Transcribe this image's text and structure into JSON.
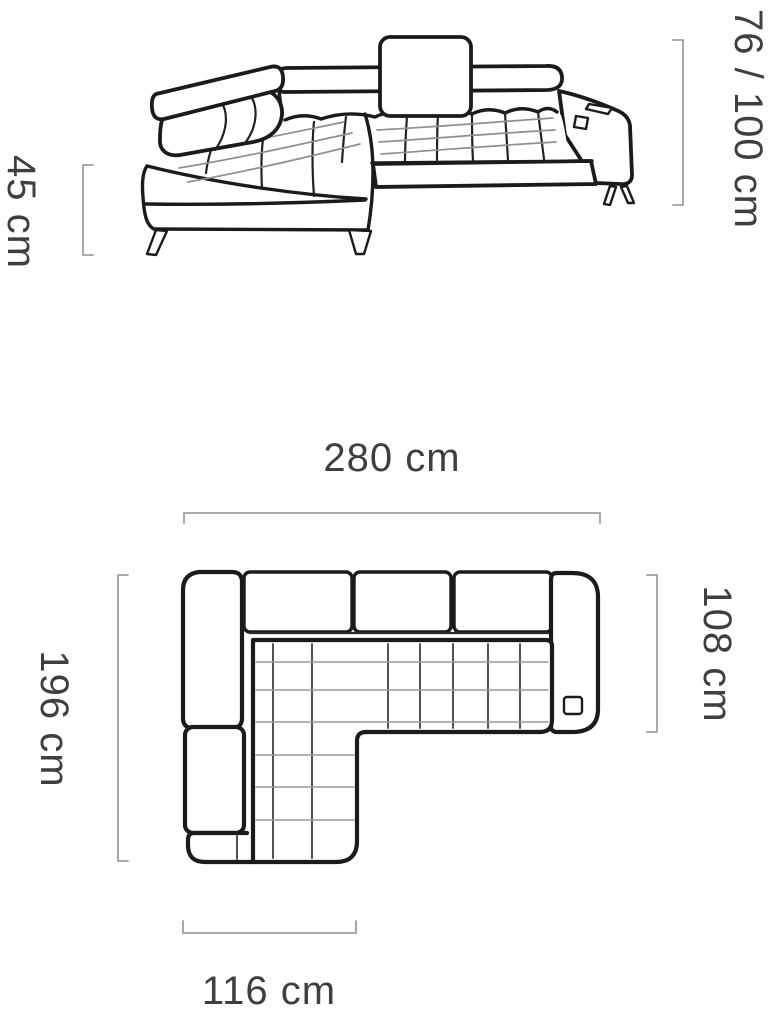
{
  "diagram": {
    "type": "furniture-dimension-diagram",
    "product": "corner-sofa",
    "views": {
      "perspective": {
        "description": "front perspective line drawing of corner sofa"
      },
      "plan": {
        "description": "top view plan of corner sofa"
      }
    },
    "dimensions": {
      "seat_height": "45 cm",
      "back_height": "76 / 100 cm",
      "total_width": "280 cm",
      "total_depth": "196 cm",
      "body_depth": "108 cm",
      "chaise_width": "116 cm"
    },
    "colors": {
      "background": "#ffffff",
      "outline": "#1b1b1b",
      "tuft_line": "#8f8f8f",
      "dimension_line": "#9e9e9e",
      "label_text": "#3f3f3f"
    }
  }
}
